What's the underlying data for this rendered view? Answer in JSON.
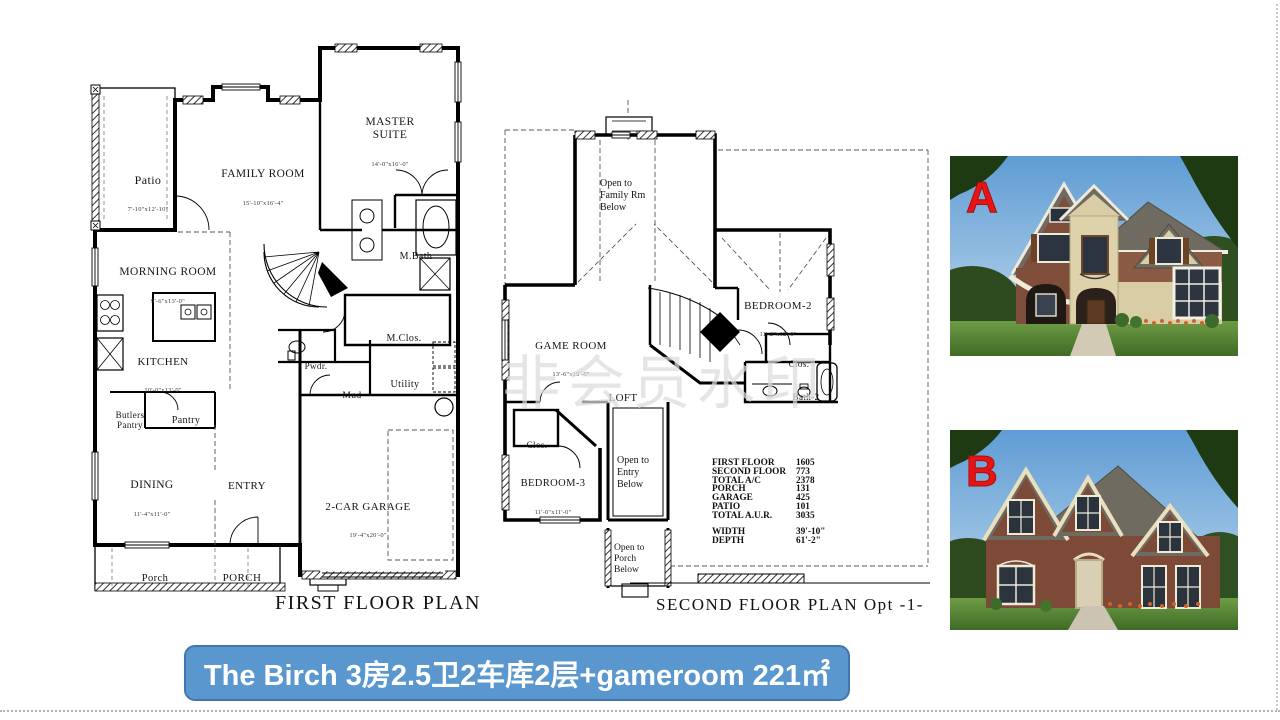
{
  "banner": {
    "text": "The Birch  3房2.5卫2车库2层+gameroom 221㎡",
    "bg_color": "#5b97cf",
    "border_color": "#4076ad",
    "text_color": "#ffffff"
  },
  "watermark": {
    "text": "非会员水印"
  },
  "first_floor": {
    "title": "FIRST FLOOR PLAN",
    "rooms": [
      {
        "name": "Patio",
        "dims": "7'-10\"x12'-10\""
      },
      {
        "name": "FAMILY ROOM",
        "dims": "15'-10\"x16'-4\""
      },
      {
        "name": "MASTER\nSUITE",
        "dims": "14'-0\"x16'-0\""
      },
      {
        "name": "MORNING ROOM",
        "dims": "9'-6\"x13'-0\""
      },
      {
        "name": "M.Bath"
      },
      {
        "name": "KITCHEN",
        "dims": "10'-0\"x13'-0\""
      },
      {
        "name": "M.Clos."
      },
      {
        "name": "Pwdr."
      },
      {
        "name": "Mud"
      },
      {
        "name": "Utility"
      },
      {
        "name": "Butlers\nPantry"
      },
      {
        "name": "Pantry"
      },
      {
        "name": "DINING",
        "dims": "11'-4\"x11'-0\""
      },
      {
        "name": "ENTRY"
      },
      {
        "name": "2-CAR GARAGE",
        "dims": "19'-4\"x20'-0\""
      },
      {
        "name": "Porch"
      },
      {
        "name": "PORCH"
      }
    ]
  },
  "second_floor": {
    "title": "SECOND FLOOR PLAN Opt -1-",
    "rooms": [
      {
        "name": "Open to\nFamily Rm\nBelow"
      },
      {
        "name": "BEDROOM-2",
        "dims": "11'-2\"x12'-0\""
      },
      {
        "name": "Clos."
      },
      {
        "name": "Bath-2"
      },
      {
        "name": "GAME ROOM",
        "dims": "13'-6\"x15'-6\""
      },
      {
        "name": "LOFT"
      },
      {
        "name": "Clos."
      },
      {
        "name": "BEDROOM-3",
        "dims": "11'-0\"x11'-0\""
      },
      {
        "name": "Open to\nEntry\nBelow"
      },
      {
        "name": "Open to\nPorch\nBelow"
      }
    ],
    "stats": [
      {
        "label": "FIRST FLOOR",
        "value": "1605"
      },
      {
        "label": "SECOND FLOOR",
        "value": "773"
      },
      {
        "label": "TOTAL A/C",
        "value": "2378"
      },
      {
        "label": "PORCH",
        "value": "131"
      },
      {
        "label": "GARAGE",
        "value": "425"
      },
      {
        "label": "PATIO",
        "value": "101"
      },
      {
        "label": "TOTAL A.U.R.",
        "value": "3035"
      }
    ],
    "size": [
      {
        "label": "WIDTH",
        "value": "39'-10\""
      },
      {
        "label": "DEPTH",
        "value": "61'-2\""
      }
    ]
  },
  "photos": [
    {
      "label": "A",
      "label_color": "#e81414"
    },
    {
      "label": "B",
      "label_color": "#e81414"
    }
  ]
}
